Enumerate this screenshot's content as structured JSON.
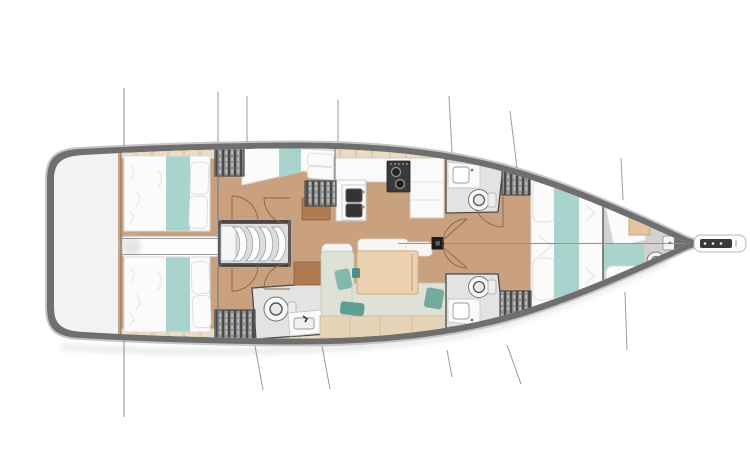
{
  "diagram": {
    "kind": "sailing-yacht-interior-deck-plan",
    "orientation": "bow-right-stern-left",
    "regions": [
      {
        "id": "stern-deck",
        "label": "stern deck"
      },
      {
        "id": "aft-cabin-top",
        "label": "aft double cabin top"
      },
      {
        "id": "aft-cabin-bottom",
        "label": "aft double cabin bottom"
      },
      {
        "id": "engine-corridor",
        "label": "center passage"
      },
      {
        "id": "companionway-stairs",
        "label": "companionway steps"
      },
      {
        "id": "mid-cabin-top",
        "label": "midship berth"
      },
      {
        "id": "galley",
        "label": "galley with stove and twin sinks"
      },
      {
        "id": "aft-head",
        "label": "aft bathroom with toilet and sink"
      },
      {
        "id": "salon-dinette",
        "label": "salon dinette with table"
      },
      {
        "id": "head-top",
        "label": "forward bathroom top"
      },
      {
        "id": "head-bottom",
        "label": "forward bathroom bottom"
      },
      {
        "id": "mast-step",
        "label": "mast foot on centerline"
      },
      {
        "id": "forward-cabin",
        "label": "forward V-berth cabin"
      },
      {
        "id": "forepeak-cabin",
        "label": "forepeak berth with toilet"
      },
      {
        "id": "bowsprit",
        "label": "bow anchor fitting"
      },
      {
        "id": "rigging-lines",
        "label": "rigging stay lines"
      }
    ]
  },
  "palette": {
    "hull-band": "#6f6f6f",
    "hull-outline": "#c6c6c6",
    "deck-white": "#f2f2f2",
    "wood-floor": "#c9a17e",
    "shelf-beige": "#e9dcc4",
    "shelf-seam": "#c9b897",
    "bed-white": "#fbfbfb",
    "bed-edge": "#dcdcdc",
    "ruffle": "#e8e8e8",
    "teal": "#a9d4cd",
    "teal-dark": "#63a79a",
    "locker-gray": "#8e8e8e",
    "locker-dark": "#4a4a4a",
    "counter-white": "#fafafa",
    "counter-edge": "#c9c9c9",
    "appliance-dark": "#3a3a3a",
    "head-floor": "#e3e3e3",
    "porcelain": "#f8f8f8",
    "fixture-line": "#777777",
    "wall-dark": "#4a4a4a",
    "wall-mid": "#7a7a7a",
    "sofa-sage": "#dde1d6",
    "sofa-edge": "#c2c8bb",
    "sofa-pad": "#f5f5f3",
    "bench-beige": "#e6d4b8",
    "bench-edge": "#cdb392",
    "table-tan": "#ecd2b0",
    "table-edge": "#d3b288",
    "cabinet-brown": "#ae7b52",
    "cabinet-edge": "#8a5c39",
    "door-arc": "#8a6546",
    "rigging": "#9b9b9b",
    "mast-black": "#1c1c1c",
    "centerline": "#8d8d8d",
    "shadow": "#e0e0e0"
  }
}
